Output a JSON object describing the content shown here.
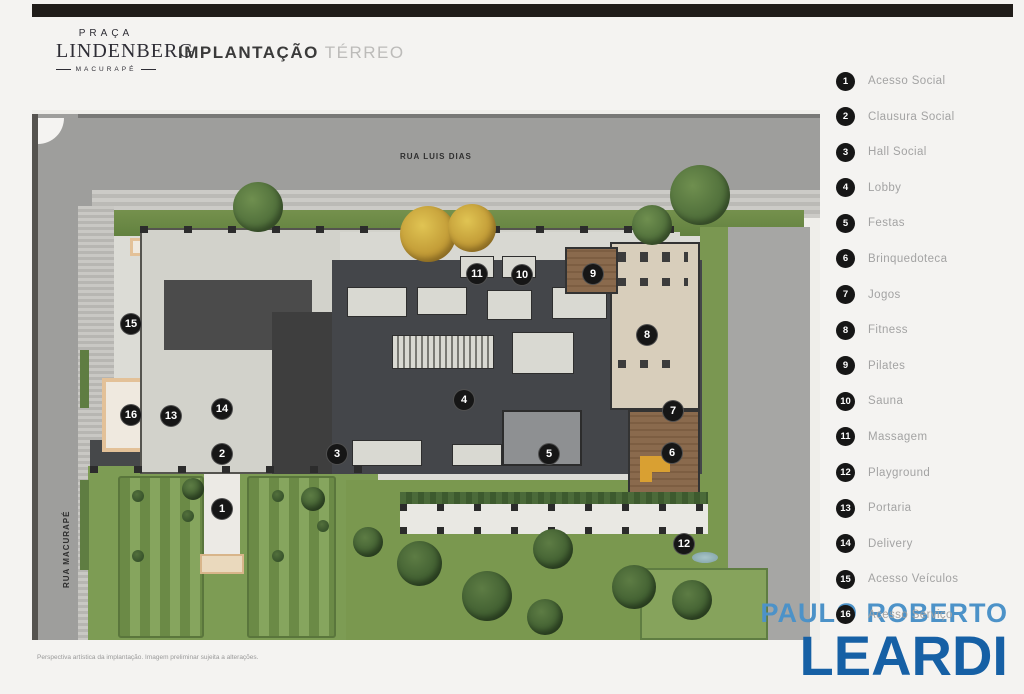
{
  "header": {
    "brand": {
      "line1": "PRAÇA",
      "line2": "LINDENBERG",
      "line3": "MACURAPÉ"
    },
    "title": "IMPLANTAÇÃO",
    "subtitle": "TÉRREO"
  },
  "plan": {
    "streets": [
      {
        "name": "RUA LUIS DIAS"
      },
      {
        "name": "RUA MACURAPÉ"
      }
    ],
    "markers": [
      {
        "n": "1",
        "x": 190,
        "y": 399
      },
      {
        "n": "2",
        "x": 190,
        "y": 344
      },
      {
        "n": "3",
        "x": 305,
        "y": 344
      },
      {
        "n": "4",
        "x": 432,
        "y": 290
      },
      {
        "n": "5",
        "x": 517,
        "y": 344
      },
      {
        "n": "6",
        "x": 640,
        "y": 343
      },
      {
        "n": "7",
        "x": 641,
        "y": 301
      },
      {
        "n": "8",
        "x": 615,
        "y": 225
      },
      {
        "n": "9",
        "x": 561,
        "y": 164
      },
      {
        "n": "10",
        "x": 490,
        "y": 165
      },
      {
        "n": "11",
        "x": 445,
        "y": 164
      },
      {
        "n": "12",
        "x": 652,
        "y": 434
      },
      {
        "n": "13",
        "x": 139,
        "y": 306
      },
      {
        "n": "14",
        "x": 190,
        "y": 299
      },
      {
        "n": "15",
        "x": 99,
        "y": 214
      },
      {
        "n": "16",
        "x": 99,
        "y": 305
      }
    ]
  },
  "legend": {
    "items": [
      {
        "number": "1",
        "label": "Acesso Social"
      },
      {
        "number": "2",
        "label": "Clausura Social"
      },
      {
        "number": "3",
        "label": "Hall Social"
      },
      {
        "number": "4",
        "label": "Lobby"
      },
      {
        "number": "5",
        "label": "Festas"
      },
      {
        "number": "6",
        "label": "Brinquedoteca"
      },
      {
        "number": "7",
        "label": "Jogos"
      },
      {
        "number": "8",
        "label": "Fitness"
      },
      {
        "number": "9",
        "label": "Pilates"
      },
      {
        "number": "10",
        "label": "Sauna"
      },
      {
        "number": "11",
        "label": "Massagem"
      },
      {
        "number": "12",
        "label": "Playground"
      },
      {
        "number": "13",
        "label": "Portaria"
      },
      {
        "number": "14",
        "label": "Delivery"
      },
      {
        "number": "15",
        "label": "Acesso Veículos"
      },
      {
        "number": "16",
        "label": "Acesso Serviço"
      }
    ]
  },
  "logo": {
    "line1": "PAULO ROBERTO",
    "line2": "LEARDI"
  },
  "footer": {
    "disclaimer": "Perspectiva artística da implantação. Imagem preliminar sujeita a alterações."
  },
  "colors": {
    "logo_light_blue": "#4C92C8",
    "logo_dark_blue": "#1660A5",
    "marker_black": "#161616",
    "legend_text_gray": "#A3A3A3",
    "street_gray": "#9E9E9C",
    "lawn_green": "#7A984F"
  }
}
